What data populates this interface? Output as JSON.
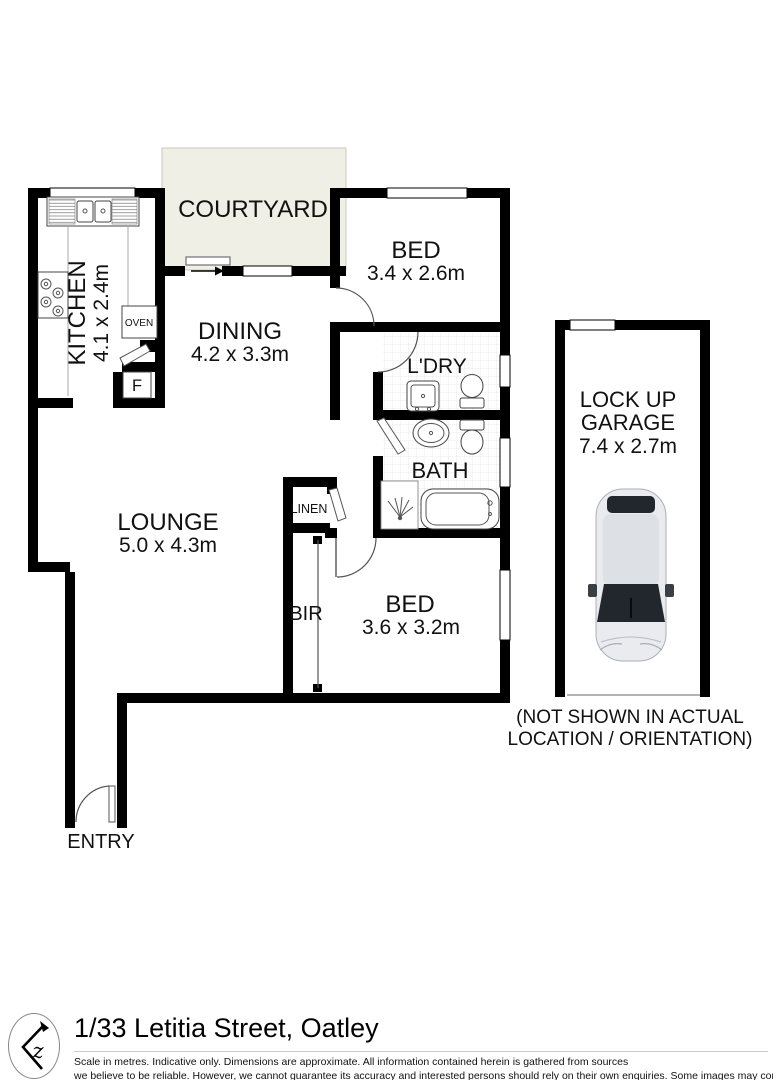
{
  "plan": {
    "courtyard": "COURTYARD",
    "kitchen": {
      "name": "KITCHEN",
      "dims": "4.1 x 2.4m"
    },
    "dining": {
      "name": "DINING",
      "dims": "4.2 x 3.3m"
    },
    "bed1": {
      "name": "BED",
      "dims": "3.4 x 2.6m"
    },
    "laundry": "L'DRY",
    "bath": "BATH",
    "lounge": {
      "name": "LOUNGE",
      "dims": "5.0 x 4.3m"
    },
    "linen": "LINEN",
    "bir": "BIR",
    "bed2": {
      "name": "BED",
      "dims": "3.6 x 3.2m"
    },
    "garage": {
      "line1": "LOCK UP",
      "line2": "GARAGE",
      "dims": "7.4 x 2.7m"
    },
    "entry": "ENTRY",
    "oven": "OVEN",
    "fridge": "F",
    "note_line1": "(NOT SHOWN IN ACTUAL",
    "note_line2": "LOCATION / ORIENTATION)"
  },
  "footer": {
    "address": "1/33 Letitia Street, Oatley",
    "logo_letter": "z",
    "disclaimer_line1": "Scale in metres. Indicative only. Dimensions are approximate. All information contained herein is gathered from sources",
    "disclaimer_line2": "we believe to be reliable. However, we cannot guarantee its accuracy and interested persons should rely on their own enquiries. Some images may contain digital furniture."
  },
  "colors": {
    "wall": "#000000",
    "courtyard_fill": "#f0efe6",
    "background": "#ffffff"
  }
}
